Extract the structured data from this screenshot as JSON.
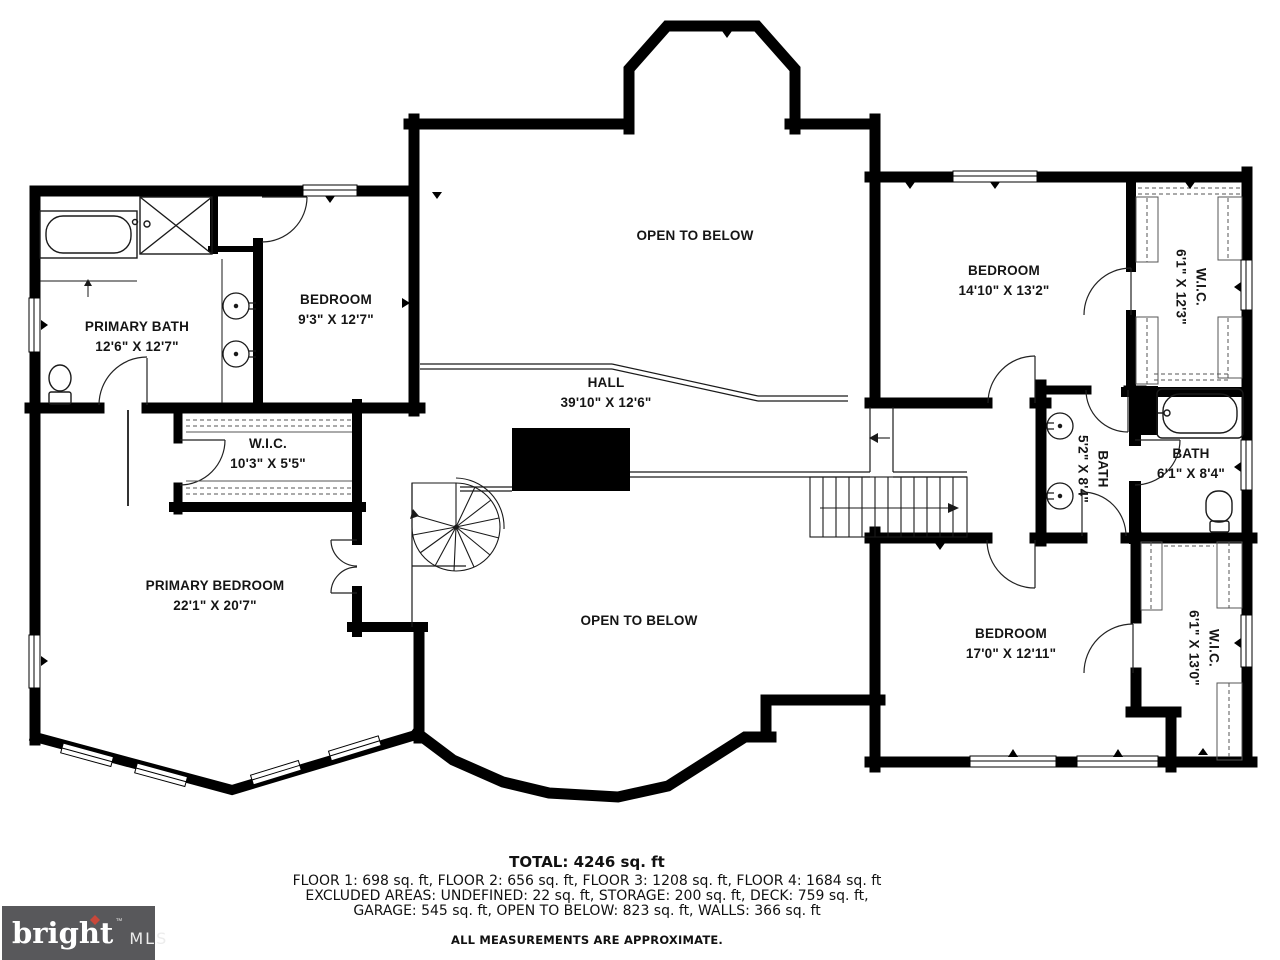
{
  "plan": {
    "rooms": [
      {
        "name": "OPEN TO BELOW",
        "dims": ""
      },
      {
        "name": "PRIMARY BATH",
        "dims": "12'6\" X 12'7\""
      },
      {
        "name": "BEDROOM",
        "dims": "9'3\" X 12'7\""
      },
      {
        "name": "BEDROOM",
        "dims": "14'10\" X 13'2\""
      },
      {
        "name": "W.I.C.",
        "dims": "6'1\" X 12'3\""
      },
      {
        "name": "HALL",
        "dims": "39'10\" X 12'6\""
      },
      {
        "name": "W.I.C.",
        "dims": "10'3\" X 5'5\""
      },
      {
        "name": "BATH",
        "dims": "5'2\" X 8'4\""
      },
      {
        "name": "BATH",
        "dims": "6'1\" X 8'4\""
      },
      {
        "name": "PRIMARY BEDROOM",
        "dims": "22'1\" X 20'7\""
      },
      {
        "name": "OPEN TO BELOW",
        "dims": ""
      },
      {
        "name": "BEDROOM",
        "dims": "17'0\" X 12'11\""
      },
      {
        "name": "W.I.C.",
        "dims": "6'1\" X 13'0\""
      }
    ]
  },
  "footer": {
    "total": "TOTAL: 4246 sq. ft",
    "floors": "FLOOR 1: 698 sq. ft, FLOOR 2: 656 sq. ft, FLOOR 3: 1208 sq. ft, FLOOR 4: 1684 sq. ft",
    "excluded1": "EXCLUDED AREAS: UNDEFINED: 22 sq. ft, STORAGE: 200 sq. ft, DECK: 759 sq. ft,",
    "excluded2": "GARAGE: 545 sq. ft, OPEN TO BELOW: 823 sq. ft, WALLS: 366 sq. ft",
    "disclaimer": "ALL MEASUREMENTS ARE APPROXIMATE."
  },
  "logo": {
    "brand": "bright",
    "tm": "™",
    "suffix": "MLS"
  },
  "colors": {
    "wall": "#000000",
    "logo_background": "#58585b",
    "logo_arrow": "#c8473a"
  }
}
